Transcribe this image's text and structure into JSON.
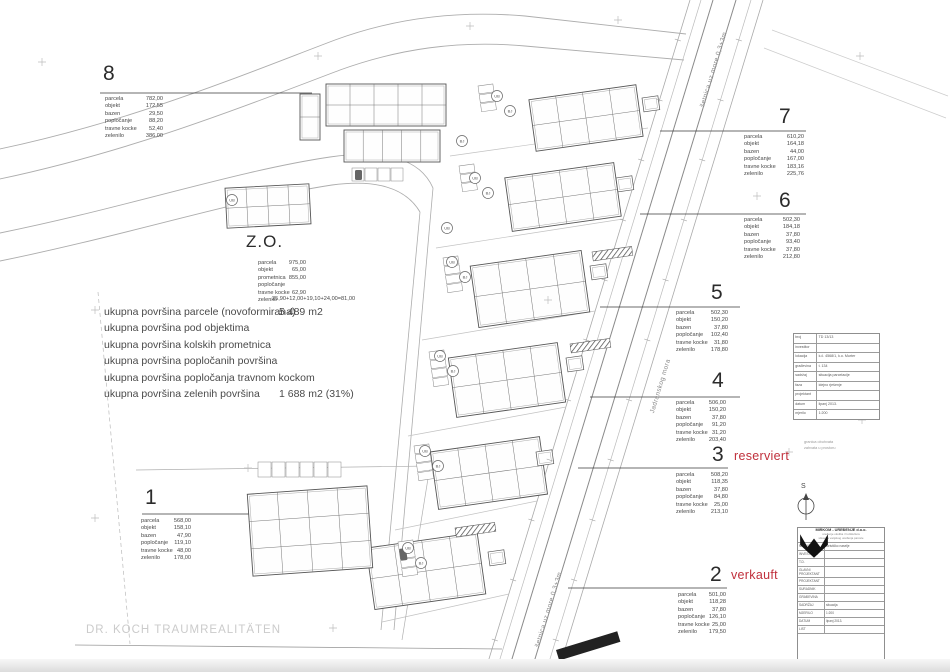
{
  "watermark": "DR. KOCH TRAUMREALITÄTEN",
  "status_color": "#c0303c",
  "roads": {
    "promenade_top": "šetnica uz more 0,3+3m",
    "street": "Jadranskog mora",
    "promenade_bottom": "šetnica uz more 0,3+3m"
  },
  "summary": {
    "rows": [
      [
        "ukupna površina parcele (novoformirana)",
        "5 489 m2"
      ],
      [
        "ukupna površina pod objektima",
        ""
      ],
      [
        "ukupna površina kolskih prometnica",
        ""
      ],
      [
        "ukupna površina popločanih površina",
        ""
      ],
      [
        "ukupna površina popločanja travnom kockom",
        ""
      ],
      [
        "ukupna površina zelenih površina",
        "1 688 m2  (31%)"
      ]
    ]
  },
  "zo": {
    "title": "Z.O.",
    "rows": [
      [
        "parcela",
        "975,00"
      ],
      [
        "objekt",
        "65,00"
      ],
      [
        "prometnica",
        "855,00"
      ],
      [
        "popločanje",
        ""
      ],
      [
        "travne kocke",
        "62,90"
      ],
      [
        "zelenilo",
        ""
      ]
    ],
    "zelenilo_formula": "25,90+12,00+19,10+24,00=81,00"
  },
  "plots": {
    "p1": {
      "number": "1",
      "rows": [
        [
          "parcela",
          "568,00"
        ],
        [
          "objekt",
          "158,10"
        ],
        [
          "bazen",
          "47,90"
        ],
        [
          "popločanje",
          "119,10"
        ],
        [
          "travne kocke",
          "48,00"
        ],
        [
          "zelenilo",
          "178,00"
        ]
      ]
    },
    "p2": {
      "number": "2",
      "status": "verkauft",
      "rows": [
        [
          "parcela",
          "501,00"
        ],
        [
          "objekt",
          "118,28"
        ],
        [
          "bazen",
          "37,80"
        ],
        [
          "popločanje",
          "126,10"
        ],
        [
          "travne kocke",
          "25,00"
        ],
        [
          "zelenilo",
          "179,50"
        ]
      ]
    },
    "p3": {
      "number": "3",
      "status": "reserviert",
      "rows": [
        [
          "parcela",
          "508,20"
        ],
        [
          "objekt",
          "118,35"
        ],
        [
          "bazen",
          "37,80"
        ],
        [
          "popločanje",
          "84,80"
        ],
        [
          "travne kocke",
          "25,00"
        ],
        [
          "zelenilo",
          "213,10"
        ]
      ]
    },
    "p4": {
      "number": "4",
      "rows": [
        [
          "parcela",
          "506,00"
        ],
        [
          "objekt",
          "150,20"
        ],
        [
          "bazen",
          "37,80"
        ],
        [
          "popločanje",
          "91,20"
        ],
        [
          "travne kocke",
          "31,20"
        ],
        [
          "zelenilo",
          "203,40"
        ]
      ]
    },
    "p5": {
      "number": "5",
      "rows": [
        [
          "parcela",
          "502,30"
        ],
        [
          "objekt",
          "150,20"
        ],
        [
          "bazen",
          "37,80"
        ],
        [
          "popločanje",
          "102,40"
        ],
        [
          "travne kocke",
          "31,80"
        ],
        [
          "zelenilo",
          "178,80"
        ]
      ]
    },
    "p6": {
      "number": "6",
      "rows": [
        [
          "parcela",
          "502,30"
        ],
        [
          "objekt",
          "184,18"
        ],
        [
          "bazen",
          "37,80"
        ],
        [
          "popločanje",
          "93,40"
        ],
        [
          "travne kocke",
          "37,80"
        ],
        [
          "zelenilo",
          "212,80"
        ]
      ]
    },
    "p7": {
      "number": "7",
      "rows": [
        [
          "parcela",
          "610,20"
        ],
        [
          "objekt",
          "164,18"
        ],
        [
          "bazen",
          "44,00"
        ],
        [
          "popločanje",
          "167,00"
        ],
        [
          "travne kocke",
          "183,16"
        ],
        [
          "zelenilo",
          "225,76"
        ]
      ]
    },
    "p8": {
      "number": "8",
      "rows": [
        [
          "parcela",
          "782,00"
        ],
        [
          "objekt",
          "172,55"
        ],
        [
          "bazen",
          "29,50"
        ],
        [
          "popločanje",
          "88,20"
        ],
        [
          "travne kocke",
          "52,40"
        ],
        [
          "zelenilo",
          "386,00"
        ]
      ]
    }
  },
  "title_block_small": {
    "rows": [
      [
        "broj",
        "TD 13/13"
      ],
      [
        "investitor",
        ""
      ],
      [
        "lokacija",
        "k.č. 4568/1, k.o. Murter"
      ],
      [
        "građevina",
        "t. 134"
      ],
      [
        "sadržaj",
        "situacija parcelacije"
      ],
      [
        "faza",
        "idejno rješenje"
      ],
      [
        "projektant",
        ""
      ],
      [
        "datum",
        "lipanj 2013."
      ],
      [
        "mjerilo",
        "1:200"
      ]
    ]
  },
  "title_block_main": {
    "company": "MIRKOM - UREĐENJE d.o.o.",
    "address1": "uređenje okoliša i hortikultura",
    "address2": "situacija vanjskog uređenja parcele",
    "rows": [
      [
        "naručitelj",
        "turističko naselje"
      ],
      [
        "investitor",
        ""
      ],
      [
        "t.d.",
        ""
      ],
      [
        "glavni projektant",
        ""
      ],
      [
        "projektant",
        ""
      ],
      [
        "suradnik",
        ""
      ],
      [
        "građevina",
        ""
      ],
      [
        "sadržaj",
        "situacija"
      ],
      [
        "mjerilo",
        "1:200"
      ],
      [
        "datum",
        "lipanj 2013."
      ],
      [
        "list",
        ""
      ]
    ]
  },
  "notes": {
    "l1": "granica obuhvata",
    "l2": "zahvata u prostoru"
  },
  "compass": {
    "north": "S"
  },
  "site": {
    "circles": [
      {
        "x": 497,
        "y": 96,
        "t": "UB"
      },
      {
        "x": 510,
        "y": 111,
        "t": "BJ"
      },
      {
        "x": 462,
        "y": 141,
        "t": "BJ"
      },
      {
        "x": 475,
        "y": 178,
        "t": "UB"
      },
      {
        "x": 488,
        "y": 193,
        "t": "BJ"
      },
      {
        "x": 447,
        "y": 228,
        "t": "UB"
      },
      {
        "x": 452,
        "y": 262,
        "t": "UB"
      },
      {
        "x": 465,
        "y": 277,
        "t": "BJ"
      },
      {
        "x": 440,
        "y": 356,
        "t": "UB"
      },
      {
        "x": 453,
        "y": 371,
        "t": "BJ"
      },
      {
        "x": 425,
        "y": 451,
        "t": "UB"
      },
      {
        "x": 438,
        "y": 466,
        "t": "BJ"
      },
      {
        "x": 408,
        "y": 548,
        "t": "UB"
      },
      {
        "x": 421,
        "y": 563,
        "t": "BJ"
      },
      {
        "x": 232,
        "y": 200,
        "t": "UB"
      }
    ]
  }
}
